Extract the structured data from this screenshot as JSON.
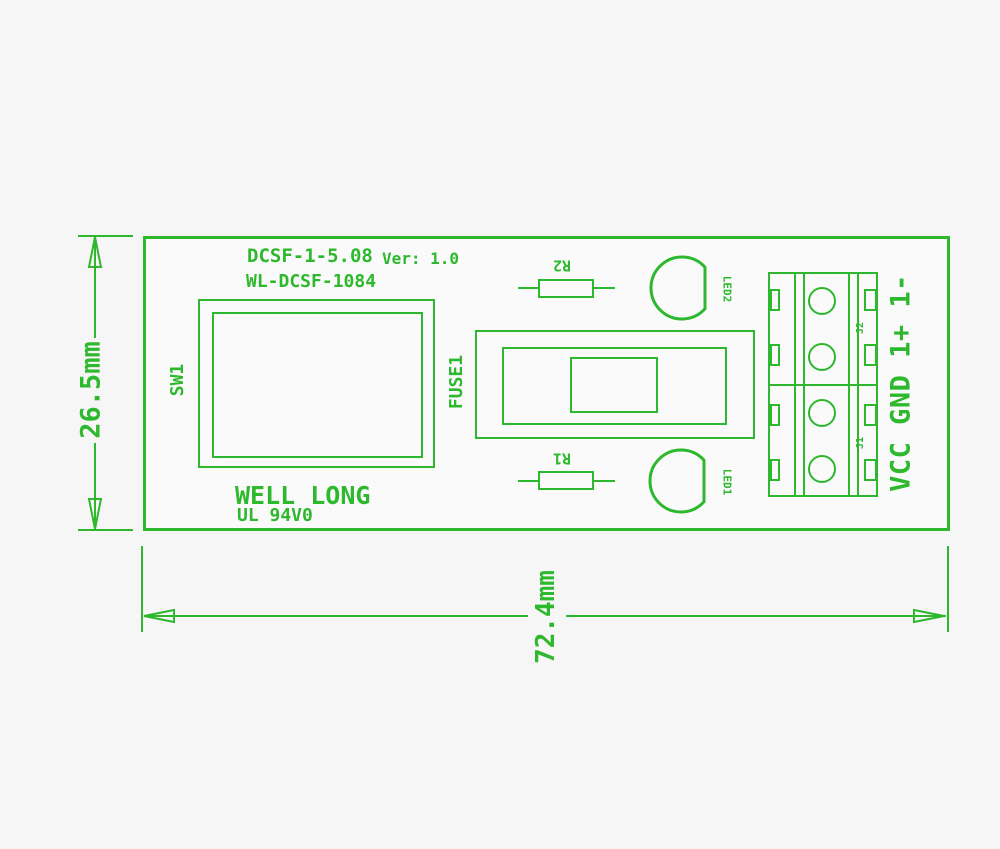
{
  "board": {
    "model": "DCSF-1-5.08",
    "version": "Ver: 1.0",
    "part_number": "WL-DCSF-1084",
    "brand": "WELL LONG",
    "rating": "UL 94V0"
  },
  "components": {
    "switch_label": "SW1",
    "fuse_label": "FUSE1",
    "resistor_top_label": "R2",
    "resistor_bottom_label": "R1",
    "led_top_label": "LED2",
    "led_bottom_label": "LED1",
    "connector_top_label": "J2",
    "connector_bottom_label": "J1",
    "terminal_pin_labels": "VCC GND 1+ 1-"
  },
  "dimensions": {
    "board_height": "26.5mm",
    "board_width": "72.4mm"
  },
  "colors": {
    "line": "#2db82d",
    "background": "#f6f6f6"
  }
}
